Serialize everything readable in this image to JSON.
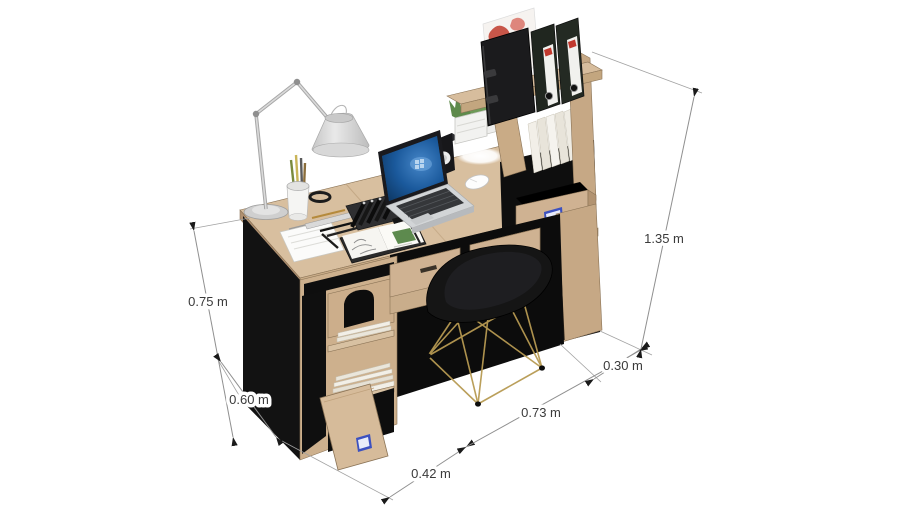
{
  "viewport": {
    "width": 910,
    "height": 512,
    "background": "#ffffff",
    "view_name": "3d-desk-workstation-model"
  },
  "model": {
    "description": "Isometric 3D render of a wooden home-office desk with hutch shelf, pedestal cabinet, open drawer and door, accessories, and a black chair with gold wire legs",
    "objects": [
      "desk-top",
      "drawer-left",
      "drawer-right",
      "pedestal-cabinet",
      "pedestal-open-door",
      "book-stacks",
      "hutch-tower",
      "hutch-top-shelf",
      "binders",
      "artwork-panel",
      "hutch-open-drawer",
      "white-books",
      "desk-lamp",
      "laptop",
      "mouse",
      "speaker",
      "planter-plants",
      "pen-cup",
      "marker-tray",
      "ruler",
      "notepad",
      "sketchbook",
      "chair"
    ],
    "colors": {
      "wood_top": "#d8bf9f",
      "wood_front": "#c9ac88",
      "wood_side": "#b09070",
      "panel_black": "#121212",
      "chair_shell": "#151515",
      "chair_legs_gold": "#b79a52",
      "lamp_metal": "#cfcfcf",
      "laptop_screen_blue": "#17548f",
      "drawer_label_blue": "#3c51c0",
      "binder_black": "#1b1b1d",
      "artwork_red": "#c0392b",
      "plant_green": "#5e8a4b",
      "paper_white": "#f4f2ec"
    }
  },
  "dimensions": {
    "unit": "m",
    "style": {
      "line_color": "#8f8f8f",
      "arrow_color": "#1a1a1a",
      "text_color": "#3a3a3a",
      "font_size_px": 13
    },
    "items": [
      {
        "name": "desk-height",
        "label": "0.75 m",
        "value": 0.75
      },
      {
        "name": "cabinet-depth",
        "label": "0.60 m",
        "value": 0.6
      },
      {
        "name": "cabinet-width",
        "label": "0.42 m",
        "value": 0.42
      },
      {
        "name": "desk-front-width",
        "label": "0.73 m",
        "value": 0.73
      },
      {
        "name": "shelf-depth",
        "label": "0.30 m",
        "value": 0.3
      },
      {
        "name": "total-height",
        "label": "1.35 m",
        "value": 1.35
      }
    ]
  }
}
